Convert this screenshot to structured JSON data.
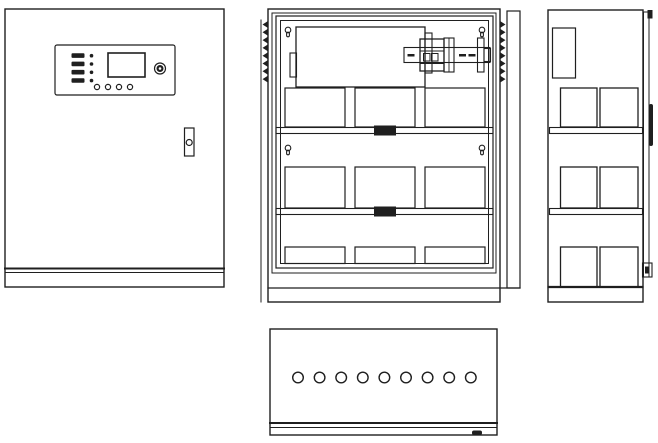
{
  "drawing": {
    "background_color": "#ffffff",
    "line_color": "#1f1f1f",
    "views": [
      {
        "id": "front",
        "name": "cabinet-front-view"
      },
      {
        "id": "internal",
        "name": "cabinet-internal-front-view"
      },
      {
        "id": "side",
        "name": "cabinet-side-view"
      },
      {
        "id": "bottom",
        "name": "cabinet-bottom-view"
      }
    ],
    "front": {
      "indicator_led_rows": 4,
      "function_buttons": 4,
      "components": [
        "control-panel",
        "lcd-display",
        "buzzer",
        "door-lock"
      ]
    },
    "internal": {
      "louver_slats_per_side": 8,
      "mounting_keyholes": 4,
      "battery_rows": 3,
      "batteries_per_row": 3,
      "shelves": 2,
      "components": [
        "power-module",
        "din-rail-circuit-breaker",
        "battery-blocks",
        "terminal-blocks",
        "open-door-panel"
      ]
    },
    "side": {
      "battery_rows": 3,
      "batteries_per_row": 2,
      "shelves": 2,
      "components": [
        "side-power-module",
        "door-edge",
        "door-handle"
      ]
    },
    "bottom": {
      "cable_entry_holes": 9,
      "components": [
        "cable-entry-plate"
      ]
    }
  }
}
